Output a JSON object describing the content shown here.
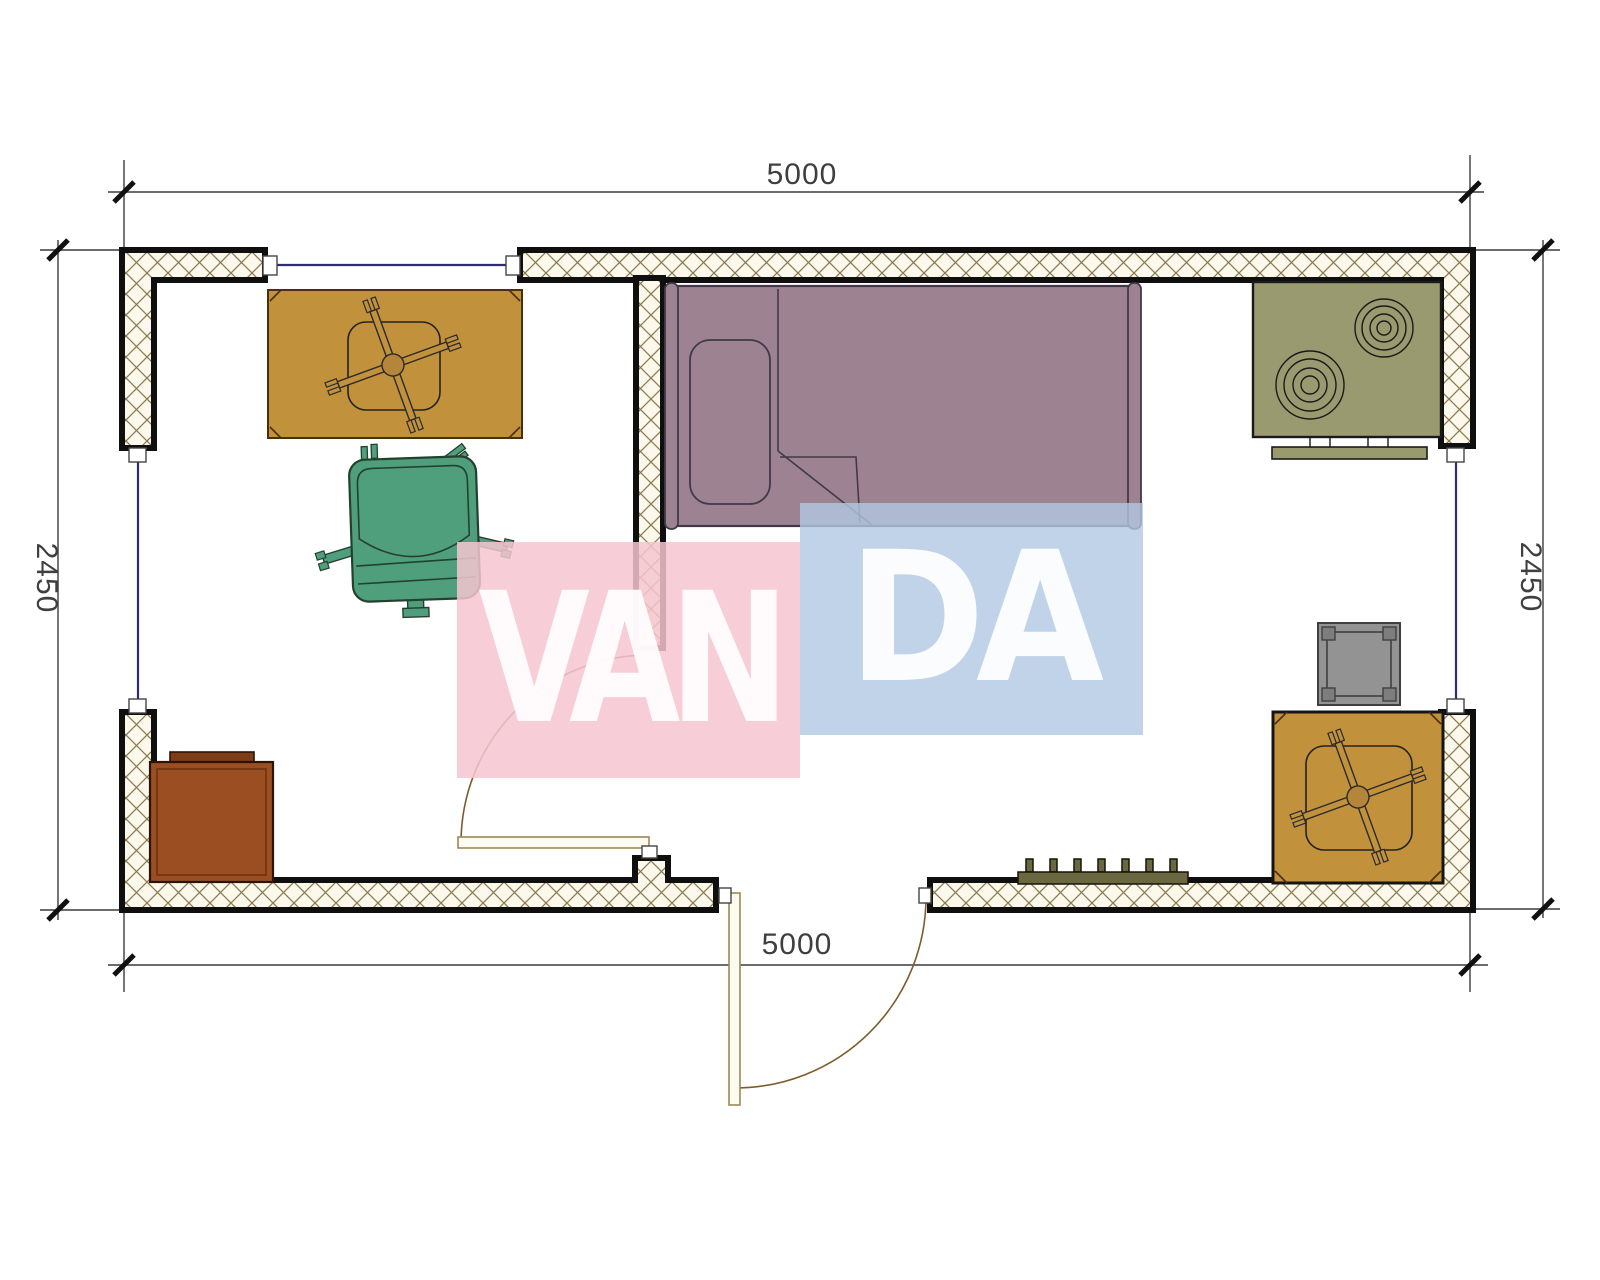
{
  "drawing": {
    "type": "architectural-floor-plan",
    "dimensions": {
      "top": "5000",
      "bottom": "5000",
      "left": "2450",
      "right": "2450"
    },
    "watermark": {
      "text": "VANDA",
      "left_part": "VAN",
      "right_part": "DA",
      "pink_block": "#f6c6d0",
      "blue_block": "#b1c8e2"
    },
    "colors": {
      "wall_outline": "#0f0f0f",
      "wall_hatch_line": "#8b7c52",
      "wall_hatch_bg": "#fdf8ec",
      "window_glass": "#2c2c6e",
      "door_leaf": "#fdfaef",
      "door_arc": "#7d5c2c",
      "table_wood": "#c2913c",
      "chair_green": "#4f9e7c",
      "bed_mauve": "#9d8391",
      "stove_olive": "#9a9a70",
      "radiator_olive": "#6b683f",
      "side_table_gray": "#939393",
      "cabinet_brown": "#9a4e22",
      "dimension_line": "#3c3c3c"
    },
    "furniture_icons": [
      "desk-table",
      "office-chair",
      "single-bed",
      "pillow",
      "cooktop-stove",
      "side-table",
      "square-table",
      "radiator",
      "cabinet"
    ]
  }
}
